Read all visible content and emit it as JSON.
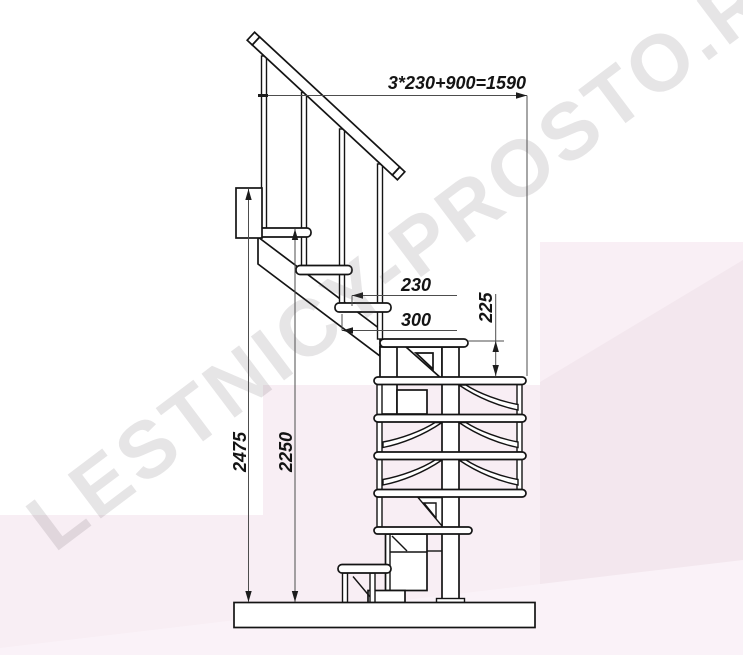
{
  "title": "Staircase side-view technical drawing",
  "watermark": {
    "text": "LESTNICY-PROSTO.RU"
  },
  "dimensions": {
    "top_run_formula": "3*230+900=1590",
    "tread_run": "230",
    "step_depth": "300",
    "riser_height": "225",
    "total_height": "2475",
    "upper_tread_height": "2250"
  },
  "colors": {
    "line": "#141414",
    "dimension_line": "#4d4d4d",
    "background": "#ffffff",
    "tint_light": "#f8eef4",
    "tint_deep": "#f3e7ee",
    "tint_pale": "#fbf3f8",
    "watermark_gray": "#e6e4e6"
  }
}
